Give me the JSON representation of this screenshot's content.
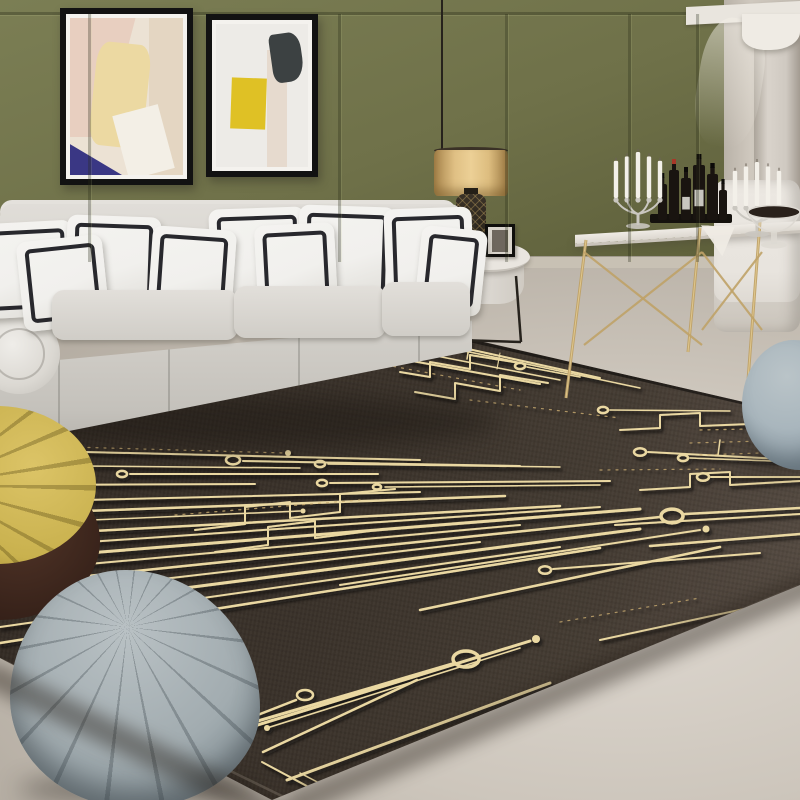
{
  "scene": {
    "label": "living room product photo - black gold circuit-board rug",
    "width": 800,
    "height": 800,
    "objects": [
      "olive paneled wall",
      "two abstract framed artworks",
      "white sofa with black-trim pillows",
      "teal books",
      "pendant drum lamp",
      "round side table with photo frame and cup",
      "gold bar console with candelabras and liquor bottles",
      "white chair",
      "draped column",
      "circuit-board area rug",
      "yellow pleated pouf",
      "gray quilted pouf",
      "blue-gray pouf"
    ]
  },
  "palette": {
    "wall-olive": "#6f7149",
    "wall-olive-light": "#7b7e54",
    "wall-olive-deep": "#5d5f3a",
    "wall-cream": "#cfc8be",
    "cornice": "#e9e5de",
    "pilaster": "#d9d3cb",
    "baseboard": "#c8c1b4",
    "floor-light": "#ded8d0",
    "floor-mid": "#cdc6bc",
    "floor-dark": "#aba398",
    "rug-mid": "#3a322a",
    "gold": "#ead8a2",
    "gold-dim": "#c8ab70",
    "sofa-light": "#e4e1dc",
    "sofa-mid": "#d3d0ca",
    "sofa-dark": "#c4c1bb",
    "pillow-white": "#f1f0ed",
    "pillow-border": "#17171c",
    "book-teal": "#4fa8b4",
    "book-pages": "#eae6dc",
    "shade-gold": "#ecd096",
    "lamp-dark": "#221d15",
    "metal-gold": "#bfa268",
    "metal-gold-hi": "#e2ca90",
    "candle-white": "#f3f0e9",
    "silver": "#cac7c0",
    "bottle-dark": "#191410",
    "tray-dark": "#14110d",
    "label-white": "#e8e5df",
    "cap-red": "#a83828",
    "chair-white": "#e8e4de",
    "curtain-white": "#efebe4",
    "pouf-yellow": "#c9b14e",
    "pouf-yellow-dark": "#97822f",
    "pouf-base-brown": "#301d16",
    "pouf-gray": "#a2acb0",
    "pouf-gray-dark": "#7c898f",
    "pouf-blue": "#a9b6bd",
    "frame-black": "#121212",
    "mat-white": "#f4f2ee",
    "metal-dark": "#26221c"
  },
  "wall": {
    "stiles": [
      88,
      338,
      505,
      628,
      696
    ]
  },
  "sofa": {
    "pillows": [
      [
        -18,
        24,
        92,
        95,
        -3
      ],
      [
        66,
        18,
        94,
        97,
        2
      ],
      [
        210,
        10,
        96,
        98,
        -2
      ],
      [
        298,
        8,
        96,
        97,
        2
      ],
      [
        385,
        10,
        88,
        95,
        -2
      ],
      [
        20,
        40,
        86,
        90,
        -6
      ],
      [
        150,
        30,
        84,
        90,
        4
      ],
      [
        256,
        26,
        80,
        86,
        -3
      ],
      [
        418,
        30,
        66,
        86,
        6
      ]
    ],
    "seats": [
      [
        52,
        92,
        186,
        50
      ],
      [
        234,
        88,
        152,
        52
      ],
      [
        382,
        84,
        88,
        54
      ]
    ],
    "pleats": [
      58,
      168,
      298,
      418
    ]
  },
  "rug": {
    "clip": [
      [
        0,
        425
      ],
      [
        432,
        330
      ],
      [
        800,
        415
      ],
      [
        800,
        585
      ],
      [
        272,
        800
      ],
      [
        0,
        658
      ]
    ],
    "top_line": [
      [
        0,
        428
      ],
      [
        432,
        332
      ],
      [
        800,
        416
      ]
    ],
    "edge_line": [
      [
        2,
        660
      ],
      [
        286,
        798
      ],
      [
        798,
        586
      ]
    ],
    "shadows": [
      {
        "x": -10,
        "y": 660,
        "w": 340,
        "h": 26,
        "rot": 26.2
      },
      {
        "x": 283,
        "y": 795,
        "w": 575,
        "h": 26,
        "rot": -23
      }
    ],
    "traces": [
      {
        "p": [
          [
            86,
            452
          ],
          [
            420,
            460
          ]
        ],
        "w": 2,
        "ring": [
          78,
          452,
          6
        ]
      },
      {
        "p": [
          [
            84,
            466
          ],
          [
            300,
            468
          ]
        ],
        "w": 1.5,
        "ring": [
          76,
          466,
          5
        ]
      },
      {
        "p": [
          [
            130,
            474
          ],
          [
            378,
            474
          ]
        ],
        "w": 2,
        "ring": [
          122,
          474,
          5
        ]
      },
      {
        "p": [
          [
            0,
            445
          ],
          [
            285,
            453
          ]
        ],
        "w": 1.2,
        "dash": 1,
        "dot": [
          288,
          453,
          3
        ]
      },
      {
        "p": [
          [
            0,
            485
          ],
          [
            255,
            484
          ]
        ],
        "w": 2
      },
      {
        "p": [
          [
            243,
            461
          ],
          [
            520,
            466
          ]
        ],
        "w": 2,
        "ring": [
          233,
          460,
          7
        ]
      },
      {
        "p": [
          [
            328,
            464
          ],
          [
            560,
            467
          ]
        ],
        "w": 1.5,
        "ring": [
          320,
          464,
          5
        ]
      },
      {
        "p": [
          [
            330,
            483
          ],
          [
            610,
            481
          ]
        ],
        "w": 2,
        "ring": [
          322,
          483,
          5
        ]
      },
      {
        "p": [
          [
            385,
            487
          ],
          [
            600,
            485
          ]
        ],
        "w": 1.5,
        "ring": [
          377,
          487,
          4
        ]
      },
      {
        "p": [
          [
            0,
            502
          ],
          [
            420,
            492
          ]
        ],
        "w": 2
      },
      {
        "p": [
          [
            0,
            514
          ],
          [
            505,
            496
          ]
        ],
        "w": 2.5
      },
      {
        "p": [
          [
            0,
            524
          ],
          [
            300,
            511
          ]
        ],
        "w": 1.5,
        "dot": [
          303,
          511,
          2.5
        ]
      },
      {
        "p": [
          [
            0,
            536
          ],
          [
            560,
            506
          ]
        ],
        "w": 2.5
      },
      {
        "p": [
          [
            0,
            548
          ],
          [
            600,
            507
          ]
        ],
        "w": 2
      },
      {
        "p": [
          [
            0,
            560
          ],
          [
            640,
            509
          ]
        ],
        "w": 3
      },
      {
        "p": [
          [
            0,
            572
          ],
          [
            520,
            525
          ]
        ],
        "w": 2
      },
      {
        "p": [
          [
            0,
            585
          ],
          [
            660,
            517
          ]
        ],
        "w": 2.5
      },
      {
        "p": [
          [
            0,
            598
          ],
          [
            480,
            542
          ]
        ],
        "w": 2
      },
      {
        "p": [
          [
            0,
            612
          ],
          [
            640,
            529
          ]
        ],
        "w": 3
      },
      {
        "p": [
          [
            0,
            627
          ],
          [
            560,
            547
          ]
        ],
        "w": 2
      },
      {
        "p": [
          [
            0,
            643
          ],
          [
            600,
            548
          ]
        ],
        "w": 2.5
      },
      {
        "p": [
          [
            195,
            530
          ],
          [
            245,
            524
          ],
          [
            245,
            507
          ],
          [
            290,
            502
          ],
          [
            290,
            518
          ],
          [
            340,
            512
          ],
          [
            340,
            494
          ],
          [
            395,
            489
          ]
        ],
        "w": 2
      },
      {
        "p": [
          [
            215,
            552
          ],
          [
            268,
            545
          ],
          [
            268,
            527
          ],
          [
            315,
            521
          ],
          [
            315,
            538
          ],
          [
            370,
            531
          ]
        ],
        "w": 2
      },
      {
        "p": [
          [
            175,
            515
          ],
          [
            360,
            500
          ]
        ],
        "w": 1.2,
        "dash": 1
      },
      {
        "p": [
          [
            200,
            738
          ],
          [
            452,
            664
          ]
        ],
        "w": 3,
        "ring": [
          466,
          659,
          13
        ]
      },
      {
        "p": [
          [
            250,
            718
          ],
          [
            296,
            700
          ]
        ],
        "w": 2.5,
        "ring": [
          305,
          695,
          8
        ]
      },
      {
        "p": [
          [
            267,
            728
          ],
          [
            520,
            648
          ]
        ],
        "w": 1.5,
        "dot": [
          267,
          728,
          3
        ]
      },
      {
        "p": [
          [
            238,
            731
          ],
          [
            530,
            641
          ]
        ],
        "w": 3,
        "dot": [
          536,
          639,
          4
        ]
      },
      {
        "p": [
          [
            263,
            752
          ],
          [
            417,
            680
          ]
        ],
        "w": 2.5
      },
      {
        "p": [
          [
            287,
            780
          ],
          [
            550,
            683
          ]
        ],
        "w": 3
      },
      {
        "p": [
          [
            262,
            762
          ],
          [
            318,
            792
          ]
        ],
        "w": 2
      },
      {
        "p": [
          [
            300,
            773
          ],
          [
            350,
            799
          ]
        ],
        "w": 1.5
      },
      {
        "p": [
          [
            372,
            800
          ],
          [
            600,
            717
          ]
        ],
        "w": 2
      },
      {
        "p": [
          [
            340,
            585
          ],
          [
            700,
            530
          ]
        ],
        "w": 2,
        "dot": [
          706,
          529,
          3.5
        ]
      },
      {
        "p": [
          [
            420,
            610
          ],
          [
            720,
            547
          ]
        ],
        "w": 2.5
      },
      {
        "p": [
          [
            553,
            569
          ],
          [
            760,
            553
          ]
        ],
        "w": 2,
        "ring": [
          545,
          570,
          6
        ]
      },
      {
        "p": [
          [
            600,
            640
          ],
          [
            790,
            599
          ]
        ],
        "w": 2
      },
      {
        "p": [
          [
            560,
            622
          ],
          [
            700,
            598
          ]
        ],
        "w": 1.2,
        "dash": 1
      },
      {
        "p": [
          [
            362,
            352
          ],
          [
            540,
            384
          ]
        ],
        "w": 2
      },
      {
        "p": [
          [
            380,
            345
          ],
          [
            560,
            380
          ]
        ],
        "w": 1.5
      },
      {
        "p": [
          [
            400,
            372
          ],
          [
            430,
            377
          ],
          [
            430,
            362
          ],
          [
            470,
            369
          ],
          [
            470,
            355
          ],
          [
            520,
            363
          ]
        ],
        "w": 2
      },
      {
        "p": [
          [
            415,
            392
          ],
          [
            455,
            399
          ],
          [
            455,
            383
          ],
          [
            500,
            391
          ],
          [
            500,
            375
          ],
          [
            548,
            383
          ]
        ],
        "w": 2
      },
      {
        "p": [
          [
            432,
            341
          ],
          [
            600,
            378
          ]
        ],
        "w": 2,
        "ring": [
          425,
          340,
          4
        ]
      },
      {
        "p": [
          [
            460,
            350
          ],
          [
            640,
            388
          ]
        ],
        "w": 1.5
      },
      {
        "p": [
          [
            370,
            362
          ],
          [
            520,
            390
          ]
        ],
        "w": 1.2,
        "dash": 1
      },
      {
        "p": [
          [
            527,
            367
          ],
          [
            580,
            377
          ]
        ],
        "w": 1.5,
        "ring": [
          520,
          366,
          5
        ]
      },
      {
        "p": [
          [
            470,
            341
          ],
          [
            467,
            359
          ]
        ],
        "w": 1.5
      },
      {
        "p": [
          [
            500,
            353
          ],
          [
            497,
            369
          ]
        ],
        "w": 1
      },
      {
        "p": [
          [
            470,
            400
          ],
          [
            620,
            418
          ]
        ],
        "w": 1.2,
        "dash": 1
      },
      {
        "p": [
          [
            648,
            452
          ],
          [
            800,
            460
          ]
        ],
        "w": 2,
        "ring": [
          640,
          452,
          6
        ]
      },
      {
        "p": [
          [
            690,
            458
          ],
          [
            800,
            462
          ]
        ],
        "w": 1.5,
        "ring": [
          683,
          458,
          5
        ]
      },
      {
        "p": [
          [
            711,
            477
          ],
          [
            800,
            477
          ]
        ],
        "w": 2,
        "ring": [
          703,
          477,
          6
        ]
      },
      {
        "p": [
          [
            685,
            514
          ],
          [
            800,
            508
          ]
        ],
        "w": 2.5,
        "ring": [
          672,
          516,
          11
        ]
      },
      {
        "p": [
          [
            620,
            430
          ],
          [
            660,
            428
          ],
          [
            660,
            415
          ],
          [
            700,
            413
          ],
          [
            700,
            426
          ],
          [
            750,
            424
          ],
          [
            750,
            410
          ],
          [
            800,
            408
          ]
        ],
        "w": 2
      },
      {
        "p": [
          [
            640,
            490
          ],
          [
            690,
            487
          ],
          [
            690,
            474
          ],
          [
            730,
            472
          ],
          [
            730,
            485
          ],
          [
            800,
            481
          ]
        ],
        "w": 2
      },
      {
        "p": [
          [
            610,
            410
          ],
          [
            730,
            411
          ]
        ],
        "w": 1.5,
        "ring": [
          603,
          410,
          5
        ]
      },
      {
        "p": [
          [
            615,
            525
          ],
          [
            800,
            514
          ]
        ],
        "w": 2
      },
      {
        "p": [
          [
            650,
            546
          ],
          [
            800,
            534
          ]
        ],
        "w": 2.5
      },
      {
        "p": [
          [
            600,
            470
          ],
          [
            720,
            469
          ]
        ],
        "w": 1.2,
        "dash": 1
      },
      {
        "p": [
          [
            700,
            430
          ],
          [
            800,
            428
          ]
        ],
        "w": 1.2,
        "dash": 1
      },
      {
        "p": [
          [
            690,
            443
          ],
          [
            800,
            440
          ]
        ],
        "w": 1.2,
        "dash": 1
      },
      {
        "p": [
          [
            700,
            455
          ],
          [
            790,
            452
          ]
        ],
        "w": 1.2,
        "dash": 1
      },
      {
        "p": [
          [
            720,
            440
          ],
          [
            718,
            455
          ]
        ],
        "w": 1.5
      },
      {
        "p": [
          [
            760,
            420
          ],
          [
            758,
            436
          ]
        ],
        "w": 1
      }
    ]
  },
  "metal": {
    "pendant_rod": [
      442,
      0,
      442,
      150
    ],
    "side_table_legs": [
      [
        462,
        300,
        459,
        340
      ],
      [
        516,
        276,
        521,
        342
      ],
      [
        459,
        340,
        521,
        342
      ]
    ],
    "console_legs": [
      [
        586,
        240,
        566,
        398
      ],
      [
        700,
        228,
        688,
        352
      ],
      [
        760,
        222,
        748,
        380
      ]
    ],
    "console_braces": [
      [
        584,
        252,
        702,
        345
      ],
      [
        584,
        345,
        702,
        252
      ],
      [
        702,
        252,
        762,
        330
      ],
      [
        702,
        330,
        762,
        252
      ]
    ]
  },
  "console": {
    "candelabras": [
      {
        "cx": 638,
        "base_y": 228,
        "top_y": 152,
        "candles": 5
      },
      {
        "cx": 757,
        "base_y": 236,
        "top_y": 162,
        "candles": 5
      }
    ],
    "tray": [
      650,
      214,
      82,
      9
    ],
    "bottles": [
      {
        "x": 658,
        "h": 36,
        "w": 9
      },
      {
        "x": 669,
        "h": 50,
        "w": 10,
        "cap": "red"
      },
      {
        "x": 681,
        "h": 42,
        "w": 10,
        "label": true
      },
      {
        "x": 693,
        "h": 55,
        "w": 12,
        "label": true
      },
      {
        "x": 707,
        "h": 46,
        "w": 11
      },
      {
        "x": 719,
        "h": 30,
        "w": 8
      }
    ],
    "bowl": {
      "cx": 774,
      "rim_y": 212,
      "rx": 26
    }
  }
}
